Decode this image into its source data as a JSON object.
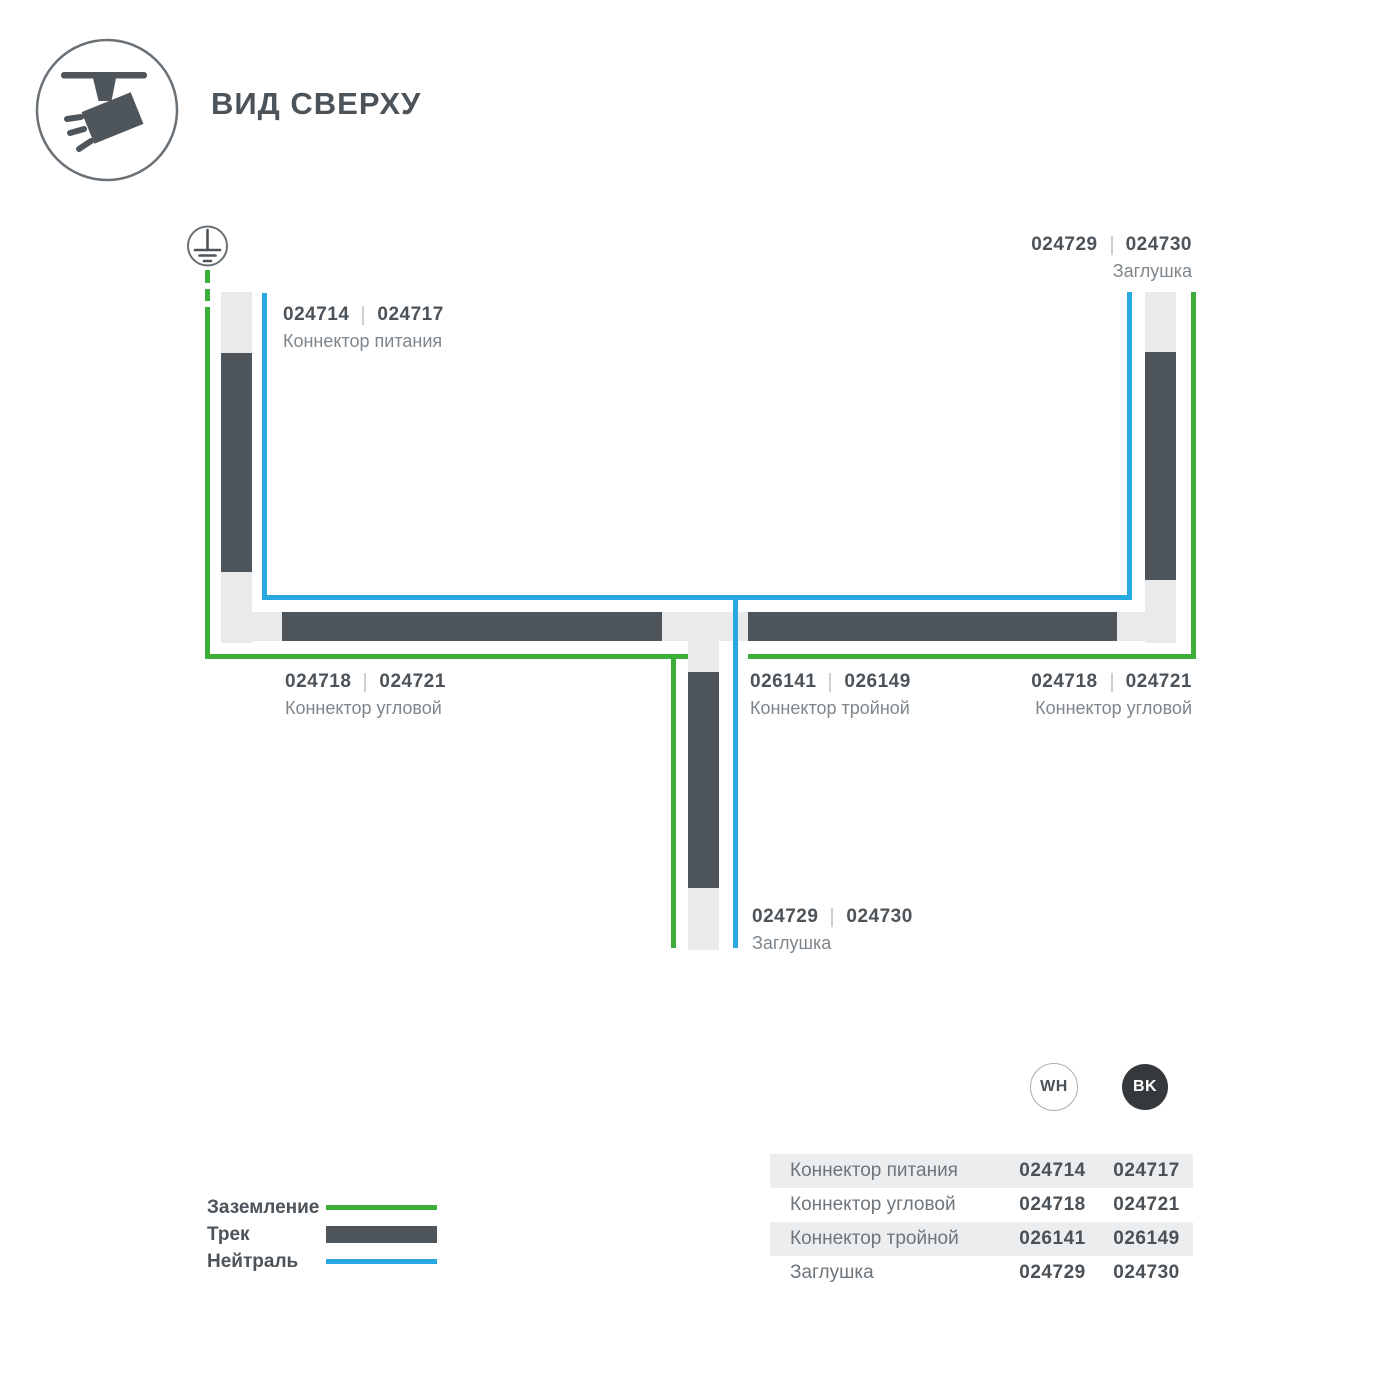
{
  "header": {
    "title": "ВИД СВЕРХУ"
  },
  "icons": {
    "top_left": "track-spotlight-icon",
    "diagram_ground": "ground-earth-icon"
  },
  "colors": {
    "ground_green": "#3eae3b",
    "neutral_blue": "#29a9e1",
    "track_dark": "#4e555b",
    "track_light": "#e9eaeb",
    "text_dark": "#4c545a",
    "text_gray": "#7e868c",
    "table_stripe": "#ebedee",
    "bk_circle": "#36393c"
  },
  "diagram": {
    "labels": [
      {
        "id": "power-connector",
        "codes": [
          "024714",
          "024717"
        ],
        "name": "Коннектор питания"
      },
      {
        "id": "endcap-top-right",
        "codes": [
          "024729",
          "024730"
        ],
        "name": "Заглушка"
      },
      {
        "id": "corner-connector-left",
        "codes": [
          "024718",
          "024721"
        ],
        "name": "Коннектор угловой"
      },
      {
        "id": "triple-connector",
        "codes": [
          "026141",
          "026149"
        ],
        "name": "Коннектор тройной"
      },
      {
        "id": "corner-connector-right",
        "codes": [
          "024718",
          "024721"
        ],
        "name": "Коннектор угловой"
      },
      {
        "id": "endcap-bottom",
        "codes": [
          "024729",
          "024730"
        ],
        "name": "Заглушка"
      }
    ]
  },
  "legend": [
    {
      "label": "Заземление",
      "swatch": "ground-line"
    },
    {
      "label": "Трек",
      "swatch": "track-bar"
    },
    {
      "label": "Нейтраль",
      "swatch": "neutral-line"
    }
  ],
  "variants": {
    "white": "WH",
    "black": "BK"
  },
  "table": {
    "rows": [
      {
        "name": "Коннектор питания",
        "wh": "024714",
        "bk": "024717"
      },
      {
        "name": "Коннектор угловой",
        "wh": "024718",
        "bk": "024721"
      },
      {
        "name": "Коннектор тройной",
        "wh": "026141",
        "bk": "026149"
      },
      {
        "name": "Заглушка",
        "wh": "024729",
        "bk": "024730"
      }
    ]
  }
}
